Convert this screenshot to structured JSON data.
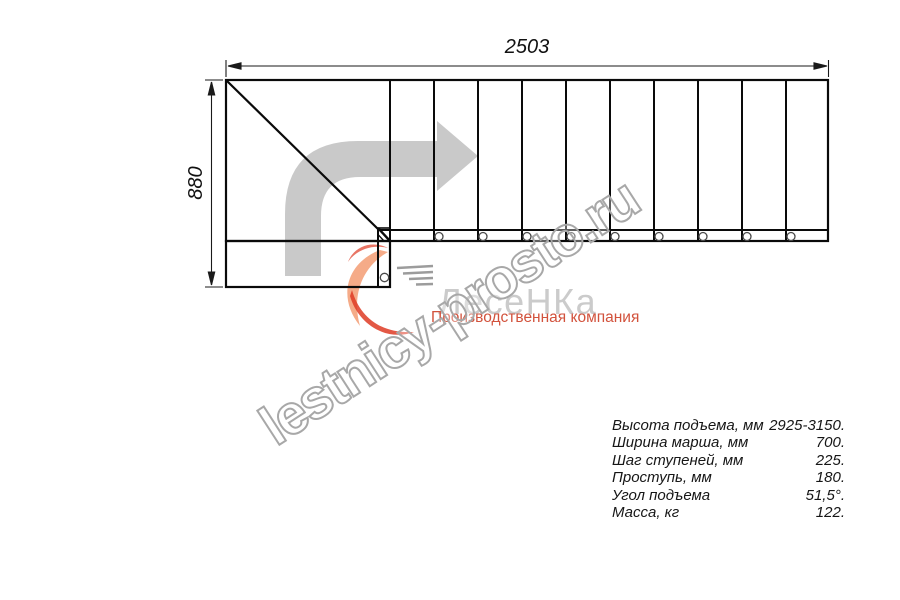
{
  "drawing": {
    "width_label": "2503",
    "height_label": "880",
    "direction_arrow_icon": "turn-right-arrow"
  },
  "watermark": {
    "text": "lestnicy-prosto.ru"
  },
  "logo": {
    "name": "ЛесеНКа",
    "tagline": "Производственная компания",
    "mark_icon": "swoosh-stairs-icon",
    "colors": {
      "orange": "#f5ab88",
      "red": "#de3b24",
      "name_gray": "#cbcbcb",
      "tagline_red": "#d2523c"
    }
  },
  "specs": {
    "rows": [
      {
        "label": "Высота подъема, мм",
        "value": "2925-3150."
      },
      {
        "label": "Ширина марша, мм",
        "value": "700."
      },
      {
        "label": "Шаг ступеней, мм",
        "value": "225."
      },
      {
        "label": "Проступь, мм",
        "value": "180."
      },
      {
        "label": "Угол подъема",
        "value": "51,5°."
      },
      {
        "label": "Масса, кг",
        "value": "122."
      }
    ]
  },
  "colors": {
    "line_black": "#0a0a0a",
    "arrow_gray": "#c9c9c9",
    "watermark_gray": "#a8a8a8",
    "background": "#ffffff"
  }
}
